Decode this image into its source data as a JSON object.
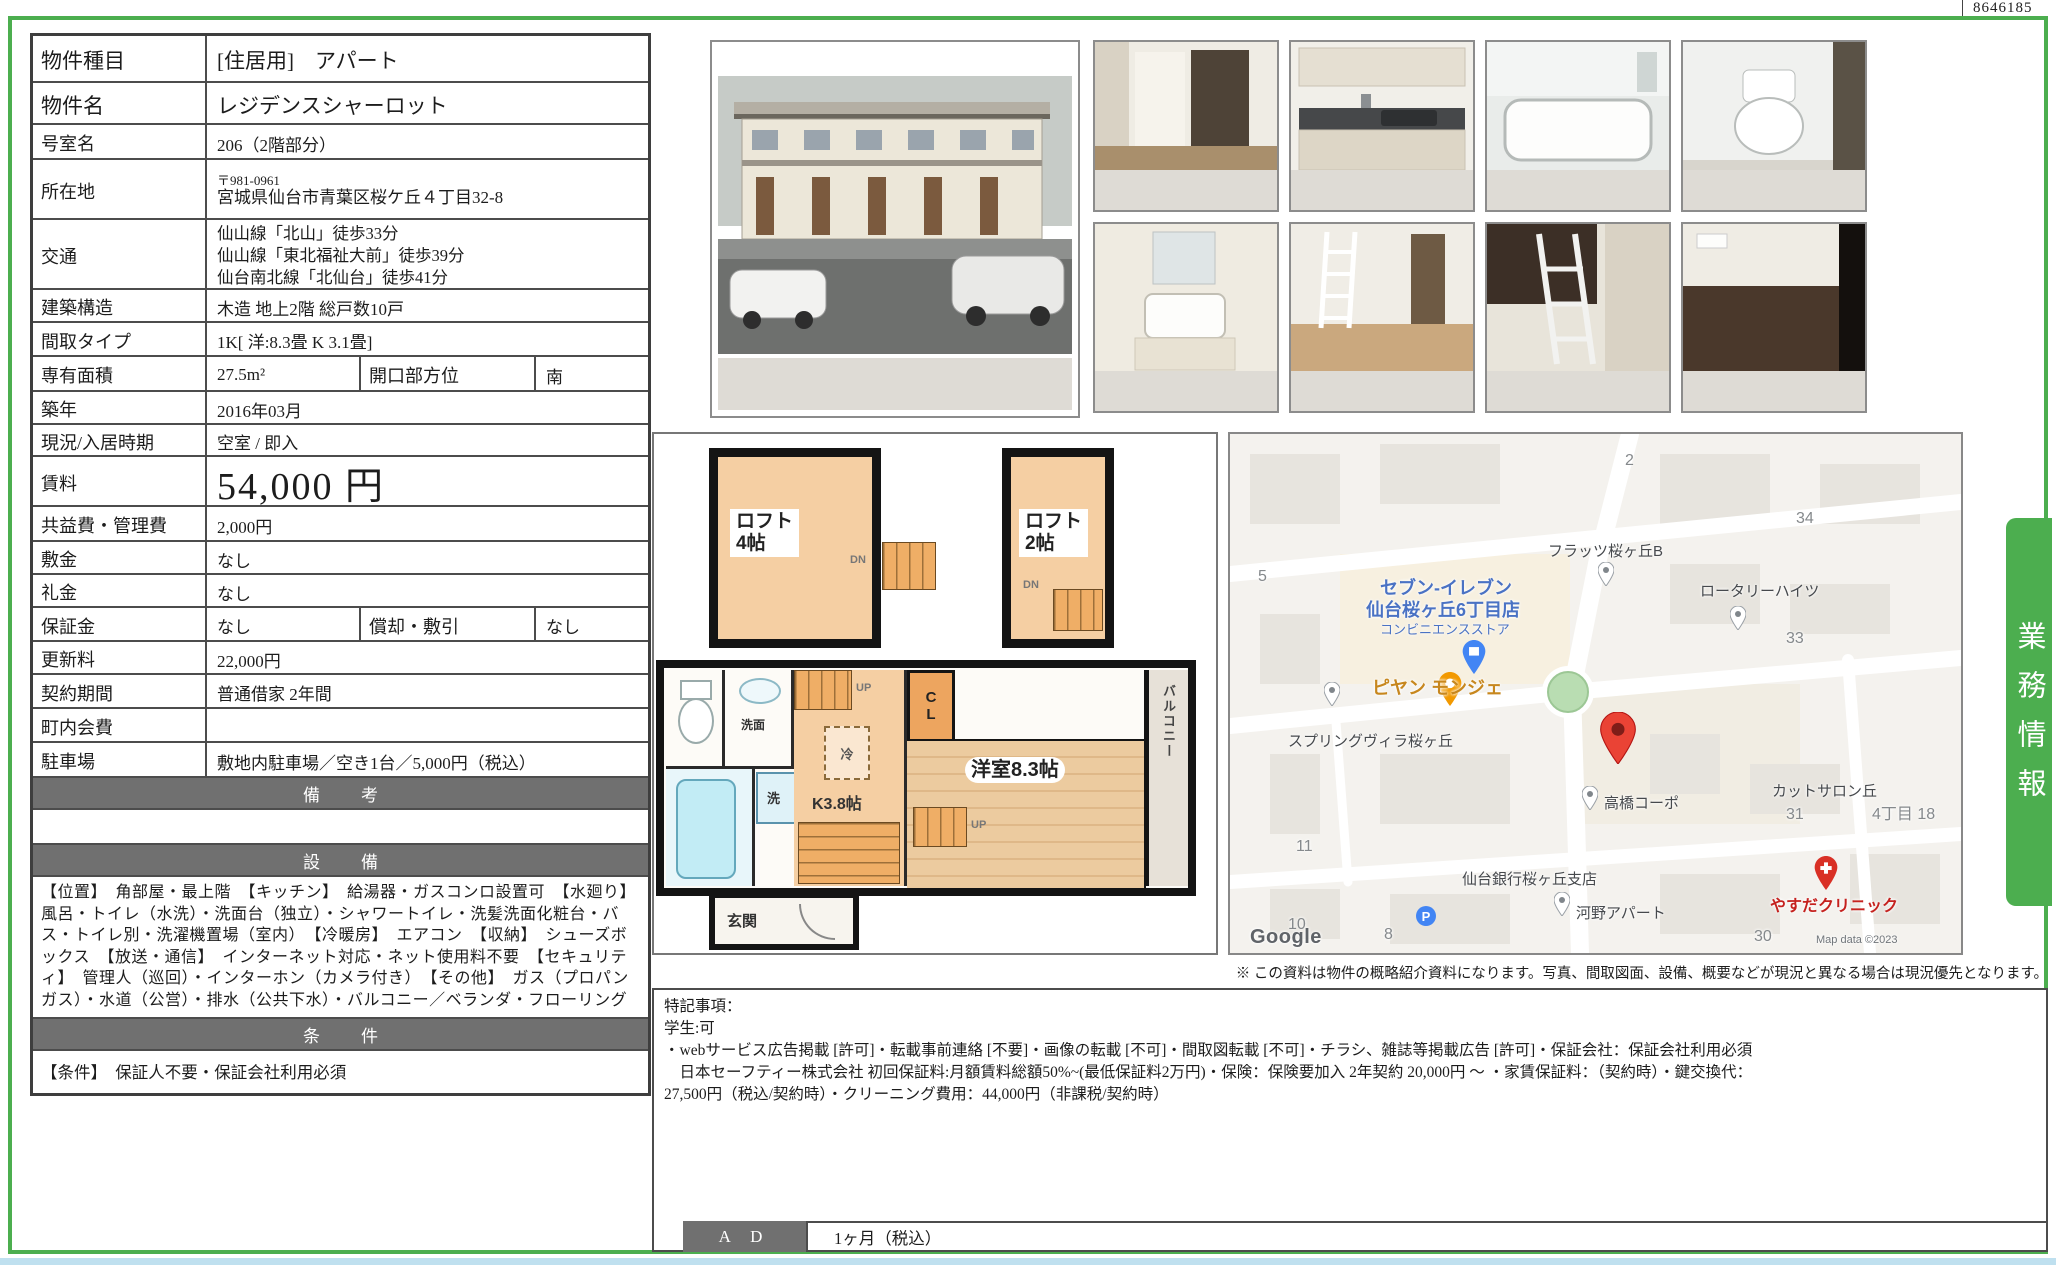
{
  "page": {
    "doc_number": "8646185",
    "side_tab": "業務情報",
    "map_note": "※ この資料は物件の概略紹介資料になります。写真、間取図面、設備、概要などが現況と異なる場合は現況優先となります。",
    "accent_green": "#4cae4f"
  },
  "table": {
    "rows": [
      {
        "label": "物件種目",
        "value": "[住居用]　アパート"
      },
      {
        "label": "物件名",
        "value": "レジデンスシャーロット"
      },
      {
        "label": "号室名",
        "value": "206（2階部分）"
      },
      {
        "label": "所在地",
        "postal": "〒981-0961",
        "value": "宮城県仙台市青葉区桜ケ丘４丁目32-8"
      },
      {
        "label": "交通",
        "lines": [
          "仙山線「北山」徒歩33分",
          "仙山線「東北福祉大前」徒歩39分",
          "仙台南北線「北仙台」徒歩41分"
        ]
      },
      {
        "label": "建築構造",
        "value": "木造 地上2階 総戸数10戸"
      },
      {
        "label": "間取タイプ",
        "value": "1K[ 洋:8.3畳 K 3.1畳]"
      },
      {
        "label": "専有面積",
        "value": "27.5m²",
        "label2": "開口部方位",
        "value2": "南"
      },
      {
        "label": "築年",
        "value": "2016年03月"
      },
      {
        "label": "現況/入居時期",
        "value": "空室 / 即入"
      },
      {
        "label": "賃料",
        "value": "54,000 円"
      },
      {
        "label": "共益費・管理費",
        "value": "2,000円"
      },
      {
        "label": "敷金",
        "value": "なし"
      },
      {
        "label": "礼金",
        "value": "なし"
      },
      {
        "label": "保証金",
        "value": "なし",
        "label2": "償却・敷引",
        "value2": "なし"
      },
      {
        "label": "更新料",
        "value": "22,000円"
      },
      {
        "label": "契約期間",
        "value": "普通借家 2年間"
      },
      {
        "label": "町内会費",
        "value": ""
      },
      {
        "label": "駐車場",
        "value": "敷地内駐車場／空き1台／5,000円（税込）"
      }
    ],
    "sections": {
      "remarks_header": "備　考",
      "equipment_header": "設　備",
      "equipment_text": "【位置】　角部屋・最上階　【キッチン】　給湯器・ガスコンロ設置可　【水廻り】　風呂・トイレ（水洗）・洗面台（独立）・シャワートイレ・洗髪洗面化粧台・バス・トイレ別・洗濯機置場（室内）　【冷暖房】　エアコン　【収納】　シューズボックス　【放送・通信】　インターネット対応・ネット使用料不要　【セキュリティ】　管理人（巡回）・インターホン（カメラ付き）　【その他】　ガス（プロパンガス）・水道（公営）・排水（公共下水）・バルコニー／ベランダ・フローリング",
      "conditions_header": "条　件",
      "conditions_text": "【条件】　保証人不要・保証会社利用必須"
    }
  },
  "floor_plan": {
    "loft4": "ロフト\n4帖",
    "loft2": "ロフト\n2帖",
    "dn": "DN",
    "kitchen": "K3.8帖",
    "fridge": "冷",
    "up": "UP",
    "cl": "C\nL",
    "room": "洋室8.3帖",
    "balcony": "バルコニー",
    "entrance": "玄関",
    "washbasin": "洗面",
    "washer": "洗"
  },
  "map": {
    "labels": [
      {
        "text": "2"
      },
      {
        "text": "34"
      },
      {
        "text": "フラッツ桜ヶ丘B"
      },
      {
        "text": "5"
      },
      {
        "text": "セブン-イレブン"
      },
      {
        "text": "仙台桜ヶ丘6丁目店"
      },
      {
        "text": "コンビニエンスストア"
      },
      {
        "text": "ロータリーハイツ"
      },
      {
        "text": "33"
      },
      {
        "text": "ピヤン モンジェ"
      },
      {
        "text": "スプリングヴィラ桜ヶ丘"
      },
      {
        "text": "高橋コーポ"
      },
      {
        "text": "カットサロン丘"
      },
      {
        "text": "31"
      },
      {
        "text": "4丁目 18"
      },
      {
        "text": "11"
      },
      {
        "text": "仙台銀行桜ヶ丘支店"
      },
      {
        "text": "河野アパート"
      },
      {
        "text": "やすだクリニック"
      },
      {
        "text": "10"
      },
      {
        "text": "8"
      },
      {
        "text": "30"
      }
    ],
    "parking_glyph": "P",
    "google": "Google",
    "attribution": "Map data ©2023"
  },
  "notes": {
    "lines": [
      "特記事項：",
      "学生:可",
      "・webサービス広告掲載 [許可]・転載事前連絡 [不要]・画像の転載 [不可]・間取図転載 [不可]・チラシ、雑誌等掲載広告 [許可]・保証会社：保証会社利用必須",
      "　日本セーフティー株式会社 初回保証料:月額賃料総額50%~(最低保証料2万円)・保険：保険要加入 2年契約 20,000円 ～ ・家賃保証料：（契約時）・鍵交換代：",
      "27,500円（税込/契約時）・クリーニング費用：44,000円（非課税/契約時）"
    ]
  },
  "ad": {
    "label": "A D",
    "value": "1ヶ月（税込）"
  }
}
